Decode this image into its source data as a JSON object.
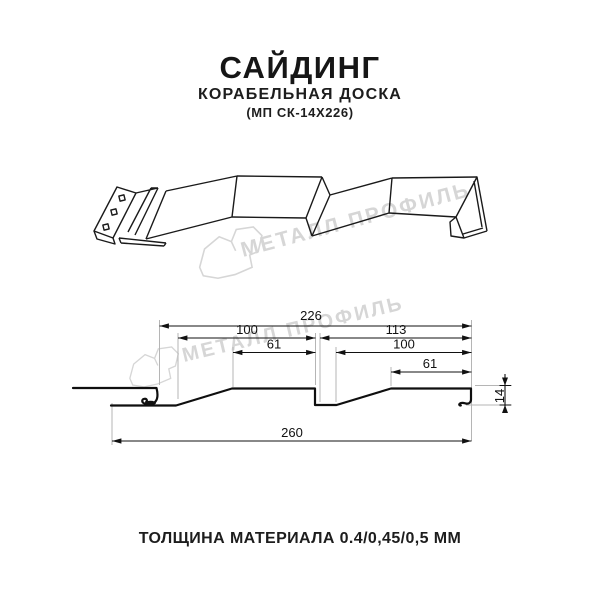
{
  "title": {
    "main": "САЙДИНГ",
    "subtitle": "КОРАБЕЛЬНАЯ ДОСКА",
    "code": "(МП СК-14Х226)"
  },
  "watermark": {
    "text": "МЕТАЛЛ ПРОФИЛЬ",
    "color": "#d6d6d6"
  },
  "drawing": {
    "type": "siding profile cross-section, two-module ship-lap board",
    "dims": {
      "module_width": "226",
      "left_segment": "100",
      "right_segment": "113",
      "left_flat": "61",
      "right_inner": "100",
      "right_flat": "61",
      "overall_width": "260",
      "profile_height": "14"
    },
    "line_color": "#1a1a1a",
    "extension_line_color": "#b5b5b5"
  },
  "footer": {
    "thickness": "ТОЛЩИНА МАТЕРИАЛА 0.4/0,45/0,5 ММ"
  }
}
